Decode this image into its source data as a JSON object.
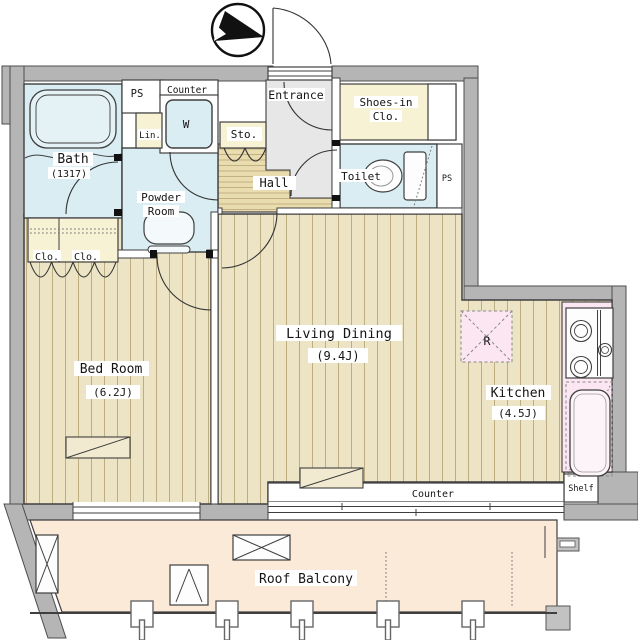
{
  "labels": {
    "bath": "Bath",
    "bath_size": "(1317)",
    "powder_line1": "Powder",
    "powder_line2": "Room",
    "ps_top": "PS",
    "ps_side": "PS",
    "laundry_counter": "Counter",
    "washer": "W",
    "linen": "Lin.",
    "storage": "Sto.",
    "hall": "Hall",
    "entrance": "Entrance",
    "shoes_line1": "Shoes-in",
    "shoes_line2": "Clo.",
    "toilet": "Toilet",
    "closet_left": "Clo.",
    "closet_right": "Clo.",
    "bedroom": "Bed Room",
    "bedroom_size": "(6.2J)",
    "living_dining": "Living Dining",
    "living_dining_size": "(9.4J)",
    "kitchen": "Kitchen",
    "kitchen_size": "(4.5J)",
    "fridge": "R",
    "ld_counter": "Counter",
    "shelf": "Shelf",
    "balcony": "Roof Balcony"
  },
  "colors": {
    "wall": "#b5b5b5",
    "floor_wood": "#ece4c4",
    "hall_wood": "#e9dcae",
    "wet_area": "#d9edf2",
    "closet_cream": "#f8f2d4",
    "kitchen_pink": "#fbe6f2",
    "balcony_peach": "#fcead9",
    "entrance_gray": "#e7e7e7",
    "outline": "#3f3f3f"
  }
}
